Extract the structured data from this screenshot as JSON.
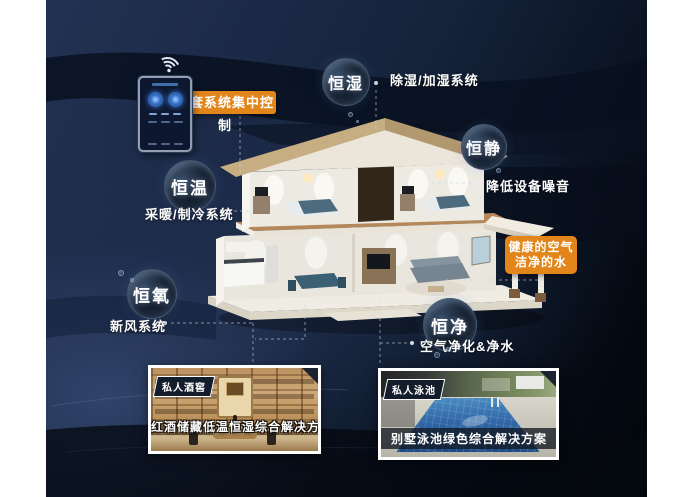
{
  "colors": {
    "accent_orange": "#E2861B",
    "background_navy": "#1C2B47",
    "text_white": "#FFFFFF",
    "pool_blue": "#2F66A6",
    "wine_wood": "#BA9159"
  },
  "control": {
    "callout": "一套系统集中控制"
  },
  "bubbles": [
    {
      "name": "恒湿",
      "note": "除湿/加湿系统"
    },
    {
      "name": "恒静",
      "note": "降低设备噪音"
    },
    {
      "name": "恒温",
      "note": "采暖/制冷系统"
    },
    {
      "name": "恒氧",
      "note": "新风系统"
    },
    {
      "name": "恒净",
      "note": "空气净化&净水"
    }
  ],
  "highlight": {
    "line1": "健康的空气",
    "line2": "洁净的水"
  },
  "photos": [
    {
      "badge": "私人酒窖",
      "caption": "红酒储藏低温恒湿综合解决方案"
    },
    {
      "badge": "私人泳池",
      "caption": "别墅泳池绿色综合解决方案"
    }
  ]
}
